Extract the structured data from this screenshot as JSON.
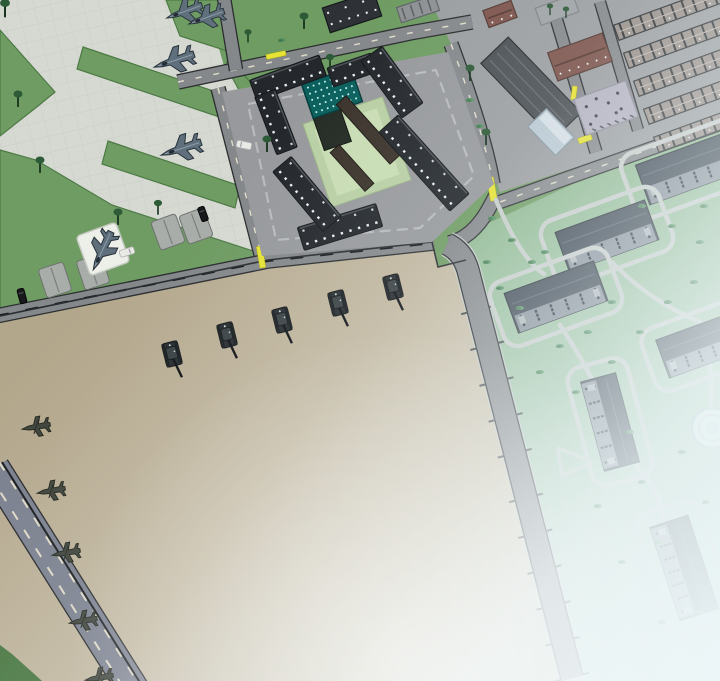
{
  "scene": {
    "view": "isometric-base-overview"
  },
  "colors": {
    "grass": "#6f9c63",
    "grass_stroke": "#4d7a45",
    "concrete": "#d6d9d2",
    "concrete_grid": "#c9cdc5",
    "town_ground": "#9b9ea0",
    "plaza": "#97999c",
    "ring": "#b8bbbd",
    "road": "#85888b",
    "road_edge": "#2b2d2f",
    "road_blue": "#7e8391",
    "dash_cream": "#ded9c8",
    "dash_black": "#17191b",
    "path": "#c6ccc9",
    "parade1": "#b2a68b",
    "parade2": "#c6bca6",
    "parade3": "#d4ccb9",
    "park1": "#8cb68c",
    "park2": "#a5c7ad",
    "park3": "#bedacd",
    "bdark": "#24282c",
    "bedge": "#4b5157",
    "win": "#e9eef1",
    "tower_roof": "#0b605e",
    "tower_dot": "#c2f2ec",
    "tower_wall": "#242b24",
    "wing": "#3b332b",
    "courtyard": "#b9cfa4",
    "courtyard2": "#c8dcb3",
    "barr_roof": "#39434e",
    "barr_roof2": "#47535f",
    "barr_face": "#848e97",
    "barr_win": "#1f2933",
    "house_brown": "#7d544c",
    "house_ridge": "#523730",
    "lot": "#b3b1c0",
    "strip_roof": "#99908a",
    "strip_dark": "#2e3134",
    "warehouse": "#4b5054",
    "wline": "#686e72",
    "annex": "#bac9d3",
    "dark_b": "#2e3236",
    "light_b": "#8d9193",
    "tree": "#2d5a37",
    "trunk": "#17321e",
    "bush": "#579264",
    "bush2": "#3f7a4e",
    "gate": "#e6e334",
    "pad": "#a9adaa",
    "jetpad": "#edefe9",
    "jet": "#5f707c",
    "jet_edge": "#27313a",
    "jet_hl": "#9fb1bc",
    "heli": "#42473f",
    "tank": "#272d30",
    "tank_turret": "#3a4245",
    "fog": "#edf6f8"
  },
  "terrain": {
    "airfield": "0,0 205,0 224,66 258,94 272,256 0,318",
    "parade": "0,316 268,260 432,242 438,267 466,260 584,681 0,681",
    "town": "430,0 720,0 720,120 500,192 452,46",
    "park": "452,240 720,116 720,681 558,681",
    "corner": "0,645 12,654 42,681 0,681",
    "wedges": [
      "0,30 55,92 38,106 0,136",
      "166,0 230,0 240,55 180,36",
      "83,47 240,100 234,122 77,69",
      "108,141 240,186 235,208 102,164",
      "0,150 36,160 112,205 256,252 268,258 0,318",
      "228,58 254,86 240,92 226,66"
    ],
    "fence": "M2,462 L149,697",
    "parade_edge": "M0,316 L268,260 L432,242 L438,267 L466,260"
  },
  "roads": [
    {
      "n": "road-top",
      "d": "M178,82 L410,33 L472,22",
      "w": 13,
      "dash": "cream"
    },
    {
      "n": "road-north",
      "d": "M224,-2 L236,70",
      "w": 12
    },
    {
      "n": "road-west",
      "d": "M218,88 L262,258",
      "w": 13,
      "dash": "cream"
    },
    {
      "n": "road-south",
      "d": "M-4,316 L268,261 L434,243",
      "w": 13,
      "dash": "black"
    },
    {
      "n": "road-east",
      "d": "M451,44 C470,95 487,148 493,184",
      "w": 13,
      "dash": "cream"
    },
    {
      "n": "road-bend",
      "d": "M449,243 Q472,238 488,210 Q493,201 497,193",
      "w": 13
    },
    {
      "n": "road-park-top",
      "d": "M500,202 L720,124",
      "w": 12,
      "dash": "cream"
    },
    {
      "n": "road-divider",
      "d": "M447,244 Q464,252 469,274 L517,462 L572,678",
      "w": 21,
      "fringe": true
    },
    {
      "n": "road-southwest",
      "d": "M-6,468 L140,700",
      "w": 30,
      "fill": "road_blue",
      "extra": [
        "M-11,474 L135,706",
        "M-1,462 L145,694"
      ]
    },
    {
      "n": "street-town-a",
      "d": "M556,18 L596,152",
      "w": 11
    },
    {
      "n": "street-town-b",
      "d": "M600,2 L638,130",
      "w": 10
    }
  ],
  "road_ticks": {
    "pts": [
      [
        469,
        274
      ],
      [
        517,
        462
      ],
      [
        572,
        678
      ]
    ],
    "step": 37,
    "len": 7,
    "half": 10.5
  },
  "hq": {
    "plaza": "222,92 448,52 494,184 432,242 262,256",
    "ring": "248,104 436,70 474,176 420,228 276,240",
    "courtyard": [
      357,
      152,
      84,
      88,
      -19
    ],
    "tower": {
      "cx": 332,
      "cy": 93,
      "w": 52,
      "h": 36,
      "rot": -19
    },
    "wings": [
      [
        368,
        130,
        13,
        80,
        -42
      ],
      [
        352,
        168,
        12,
        52,
        -42
      ]
    ],
    "buildings": [
      [
        288,
        78,
        74,
        22,
        -20
      ],
      [
        352,
        70,
        46,
        20,
        -19
      ],
      [
        392,
        82,
        26,
        70,
        -36
      ],
      [
        424,
        163,
        26,
        106,
        -42
      ],
      [
        340,
        227,
        82,
        24,
        -17
      ],
      [
        307,
        194,
        24,
        78,
        -40
      ],
      [
        276,
        122,
        22,
        62,
        -21
      ]
    ]
  },
  "town": [
    [
      "warehouse",
      531,
      88,
      105,
      38,
      46
    ],
    [
      "annex",
      551,
      132,
      40,
      26,
      46
    ],
    [
      "house",
      580,
      57,
      58,
      30,
      -20
    ],
    [
      "lot",
      606,
      108,
      55,
      38,
      -20
    ],
    [
      "house-small",
      500,
      14,
      30,
      18,
      -20
    ],
    [
      "plaza",
      557,
      10,
      40,
      18,
      -20
    ],
    [
      "dark",
      352,
      12,
      54,
      26,
      -18
    ],
    [
      "light",
      418,
      9,
      40,
      16,
      -18
    ],
    [
      "strip",
      668,
      14,
      110,
      16,
      -20
    ],
    [
      "strip",
      678,
      42,
      110,
      16,
      -20
    ],
    [
      "strip",
      688,
      70,
      110,
      16,
      -20
    ],
    [
      "strip",
      698,
      98,
      110,
      16,
      -20
    ],
    [
      "strip",
      708,
      126,
      110,
      16,
      -20
    ]
  ],
  "park": {
    "barracks": [
      [
        692,
        167,
        105,
        42,
        -20
      ],
      [
        607,
        236,
        95,
        42,
        -20
      ],
      [
        556,
        297,
        95,
        42,
        -20
      ],
      [
        704,
        344,
        88,
        40,
        -20
      ],
      [
        610,
        422,
        92,
        36,
        75
      ],
      [
        684,
        568,
        98,
        40,
        72
      ]
    ],
    "paths": [
      "M496,200 Q520,258 544,274",
      "M612,262 Q648,300 700,322",
      "M560,325 Q588,368 600,396",
      "M625,455 Q660,485 664,522",
      "M702,326 Q714,368 711,408"
    ],
    "triangle": "558,448 592,462 562,476",
    "circle": [
      712,
      428,
      20
    ],
    "bushes": [
      [
        492,
        218
      ],
      [
        512,
        240
      ],
      [
        487,
        262
      ],
      [
        532,
        262
      ],
      [
        500,
        288
      ],
      [
        520,
        308
      ],
      [
        545,
        252
      ],
      [
        560,
        346
      ],
      [
        588,
        332
      ],
      [
        540,
        372
      ],
      [
        576,
        392
      ],
      [
        612,
        362
      ],
      [
        640,
        332
      ],
      [
        668,
        302
      ],
      [
        694,
        282
      ],
      [
        700,
        242
      ],
      [
        672,
        226
      ],
      [
        642,
        206
      ],
      [
        704,
        206
      ],
      [
        612,
        302
      ],
      [
        630,
        432
      ],
      [
        598,
        506
      ],
      [
        642,
        482
      ],
      [
        682,
        452
      ],
      [
        706,
        502
      ],
      [
        658,
        542
      ],
      [
        622,
        562
      ],
      [
        700,
        612
      ],
      [
        662,
        622
      ],
      [
        470,
        100
      ],
      [
        480,
        126
      ],
      [
        282,
        40
      ]
    ]
  },
  "props": {
    "trees": [
      [
        18,
        104,
        1
      ],
      [
        40,
        170,
        1
      ],
      [
        118,
        222,
        1
      ],
      [
        158,
        212,
        0.9
      ],
      [
        267,
        149,
        1
      ],
      [
        304,
        26,
        1
      ],
      [
        330,
        66,
        0.9
      ],
      [
        470,
        78,
        1
      ],
      [
        486,
        142,
        1
      ],
      [
        5,
        14,
        1.1
      ],
      [
        550,
        13,
        0.7
      ],
      [
        566,
        16,
        0.7
      ],
      [
        248,
        40,
        0.8
      ]
    ],
    "gates": [
      [
        276,
        55,
        -12,
        20,
        5
      ],
      [
        261,
        257,
        -10,
        6,
        22
      ],
      [
        492,
        189,
        -10,
        7,
        24
      ],
      [
        574,
        93,
        8,
        5,
        14
      ],
      [
        585,
        139,
        -20,
        14,
        6
      ]
    ],
    "pads": [
      [
        168,
        232,
        -20
      ],
      [
        196,
        226,
        -20
      ],
      [
        55,
        280,
        -18
      ],
      [
        93,
        272,
        -18
      ]
    ],
    "jetpad": [
      103,
      249,
      -20
    ],
    "vehicles": [
      [
        203,
        214,
        -20,
        "dark"
      ],
      [
        22,
        296,
        -15,
        "dark"
      ],
      [
        127,
        252,
        72,
        "light"
      ],
      [
        244,
        145,
        -78,
        "light"
      ]
    ]
  },
  "units": {
    "jet_shape": "23,0 15,2.2 7,3 -1,13 -7,13 -3,3.4 -11,3.8 -15,9.5 -18.5,9.5 -15.5,3.8 -19,3.2 -19,-3.2 -15.5,-3.8 -18.5,-9.5 -15,-9.5 -11,-3.8 -3,-3.4 -7,-13 -1,-13 7,-3 15,-2.2",
    "heli_shape": "12,0 6,1.8 1,2.2 -2,9 -6,9 -3.5,2.2 -9,2.4 -11.5,6.5 -13.5,6.5 -12,2.2 -14,1.6 -14,-1.6 -12,-2.2 -13.5,-6.5 -11.5,-6.5 -9,-2.4 -3.5,-2.2 -6,-9 -2,-9 1,-2.2 6,-1.8",
    "jets": [
      [
        186,
        11,
        160,
        0.9
      ],
      [
        208,
        17,
        160,
        0.9
      ],
      [
        176,
        60,
        162,
        1
      ],
      [
        183,
        148,
        162,
        1
      ],
      [
        103,
        249,
        115,
        1
      ]
    ],
    "tanks": {
      "rot": -14,
      "positions": [
        [
          172,
          354
        ],
        [
          227,
          335
        ],
        [
          282,
          320
        ],
        [
          338,
          303
        ],
        [
          393,
          287
        ]
      ]
    },
    "helis": {
      "rot": 170,
      "scale": 1.1,
      "positions": [
        [
          35,
          427
        ],
        [
          50,
          491
        ],
        [
          65,
          553
        ],
        [
          82,
          621
        ],
        [
          98,
          678
        ]
      ]
    }
  },
  "fog_stops": [
    [
      0,
      0
    ],
    [
      0.3,
      0.12
    ],
    [
      0.55,
      0.45
    ],
    [
      0.75,
      0.8
    ],
    [
      1,
      0.97
    ]
  ]
}
